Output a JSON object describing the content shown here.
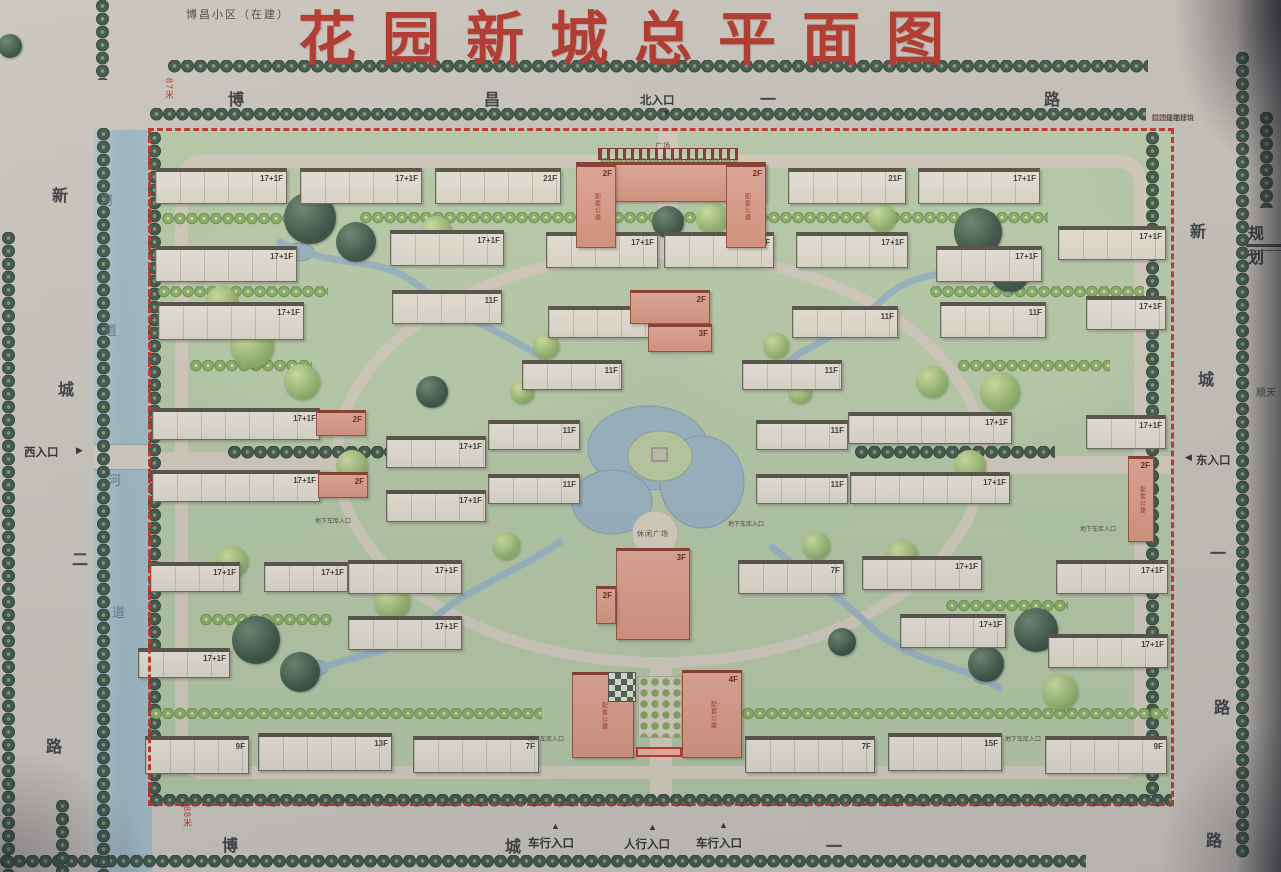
{
  "title": "花园新城总平面图",
  "adjacent": {
    "top_left_label": "博昌小区（在建）",
    "right_sheet_heading": "规划",
    "right_sheet_text": "顺天",
    "north_road_width": "87米",
    "south_road_width": "88米"
  },
  "colors": {
    "title_red": "#b5352c",
    "boundary_red": "#c5352a",
    "river_blue": "#a3bfca",
    "tree_dark": "#41594a",
    "tree_light": "#9dbf72",
    "building_white": "#e9e5da",
    "building_pink": "#dfa190",
    "road_gray": "#cfcbc4",
    "ground_green": "#b9cdae"
  },
  "legend": {
    "items": [
      {
        "label": "征地范围",
        "swatch": "red-dash"
      },
      {
        "label": "已建绿化林带",
        "swatch": "green"
      },
      {
        "label": "已建住宅建筑",
        "swatch": "white"
      },
      {
        "label": "拟建住宅建筑",
        "swatch": "pink"
      }
    ]
  },
  "roads": {
    "top": {
      "name": "博昌一路",
      "chars": [
        {
          "t": "博",
          "x": 228,
          "y": 86
        },
        {
          "t": "昌",
          "x": 484,
          "y": 86
        },
        {
          "t": "一",
          "x": 760,
          "y": 86
        },
        {
          "t": "路",
          "x": 1044,
          "y": 86
        }
      ]
    },
    "bottom": {
      "name": "博城一路",
      "chars": [
        {
          "t": "博",
          "x": 222,
          "y": 832
        },
        {
          "t": "城",
          "x": 505,
          "y": 833
        },
        {
          "t": "一",
          "x": 826,
          "y": 833
        },
        {
          "t": "路",
          "x": 1206,
          "y": 827
        }
      ]
    },
    "left": {
      "name": "新城二路",
      "chars": [
        {
          "t": "新",
          "x": 52,
          "y": 182
        },
        {
          "t": "城",
          "x": 58,
          "y": 376
        },
        {
          "t": "二",
          "x": 72,
          "y": 546
        },
        {
          "t": "路",
          "x": 46,
          "y": 733
        }
      ]
    },
    "right": {
      "name": "新城一路",
      "chars": [
        {
          "t": "新",
          "x": 1190,
          "y": 218
        },
        {
          "t": "城",
          "x": 1198,
          "y": 366
        },
        {
          "t": "一",
          "x": 1210,
          "y": 540
        },
        {
          "t": "路",
          "x": 1214,
          "y": 694
        }
      ]
    }
  },
  "river": {
    "name": "河道",
    "chars": [
      {
        "t": "河",
        "x": 100,
        "y": 190
      },
      {
        "t": "道",
        "x": 104,
        "y": 320
      },
      {
        "t": "河",
        "x": 108,
        "y": 470
      },
      {
        "t": "道",
        "x": 112,
        "y": 602
      }
    ]
  },
  "entrances": {
    "north": {
      "label": "北入口",
      "x": 640,
      "y": 92,
      "arrow": "▼",
      "ax": 662,
      "ay": 108
    },
    "west": {
      "label": "西入口",
      "x": 24,
      "y": 444,
      "arrow": "▶",
      "ax": 76,
      "ay": 445
    },
    "east": {
      "label": "东入口",
      "x": 1196,
      "y": 452,
      "arrow": "◀",
      "ax": 1185,
      "ay": 452
    },
    "south": [
      {
        "label": "车行入口",
        "x": 528,
        "y": 835,
        "arrow": "▲",
        "ax": 551,
        "ay": 821
      },
      {
        "label": "人行入口",
        "x": 624,
        "y": 836,
        "arrow": "▲",
        "ax": 648,
        "ay": 822
      },
      {
        "label": "车行入口",
        "x": 696,
        "y": 835,
        "arrow": "▲",
        "ax": 719,
        "ay": 820
      }
    ]
  },
  "map": {
    "facility_label": "配套公建",
    "plaza_labels": [
      {
        "t": "广场",
        "x": 655,
        "y": 141
      },
      {
        "t": "休闲广场",
        "x": 637,
        "y": 529
      }
    ],
    "micro_labels": [
      {
        "t": "地下车库入口",
        "x": 315,
        "y": 516
      },
      {
        "t": "地下车库入口",
        "x": 728,
        "y": 519
      },
      {
        "t": "地下车库入口",
        "x": 1080,
        "y": 524
      },
      {
        "t": "地下车库入口",
        "x": 528,
        "y": 734
      },
      {
        "t": "地下车库入口",
        "x": 1005,
        "y": 734
      }
    ],
    "buildings": [
      {
        "x": 155,
        "y": 168,
        "w": 132,
        "h": 36,
        "label": "17+1F",
        "type": "slab"
      },
      {
        "x": 300,
        "y": 168,
        "w": 122,
        "h": 36,
        "label": "17+1F",
        "type": "slab"
      },
      {
        "x": 435,
        "y": 168,
        "w": 126,
        "h": 36,
        "label": "21F",
        "type": "slab"
      },
      {
        "x": 788,
        "y": 168,
        "w": 118,
        "h": 36,
        "label": "21F",
        "type": "slab"
      },
      {
        "x": 918,
        "y": 168,
        "w": 122,
        "h": 36,
        "label": "17+1F",
        "type": "slab"
      },
      {
        "x": 1058,
        "y": 226,
        "w": 108,
        "h": 34,
        "label": "17+1F",
        "type": "slab"
      },
      {
        "x": 1086,
        "y": 296,
        "w": 80,
        "h": 34,
        "label": "17+1F",
        "type": "slab"
      },
      {
        "x": 1086,
        "y": 415,
        "w": 80,
        "h": 34,
        "label": "17+1F",
        "type": "slab"
      },
      {
        "x": 155,
        "y": 246,
        "w": 142,
        "h": 36,
        "label": "17+1F",
        "type": "slab"
      },
      {
        "x": 390,
        "y": 230,
        "w": 114,
        "h": 36,
        "label": "17+1F",
        "type": "slab"
      },
      {
        "x": 546,
        "y": 232,
        "w": 112,
        "h": 36,
        "label": "17+1F",
        "type": "slab"
      },
      {
        "x": 664,
        "y": 232,
        "w": 110,
        "h": 36,
        "label": "17+1F",
        "type": "slab"
      },
      {
        "x": 796,
        "y": 232,
        "w": 112,
        "h": 36,
        "label": "17+1F",
        "type": "slab"
      },
      {
        "x": 936,
        "y": 246,
        "w": 106,
        "h": 36,
        "label": "17+1F",
        "type": "slab"
      },
      {
        "x": 158,
        "y": 302,
        "w": 146,
        "h": 38,
        "label": "17+1F",
        "type": "slab"
      },
      {
        "x": 392,
        "y": 290,
        "w": 110,
        "h": 34,
        "label": "11F",
        "type": "slab"
      },
      {
        "x": 548,
        "y": 306,
        "w": 106,
        "h": 32,
        "label": "11F",
        "type": "slab"
      },
      {
        "x": 792,
        "y": 306,
        "w": 106,
        "h": 32,
        "label": "11F",
        "type": "slab"
      },
      {
        "x": 940,
        "y": 302,
        "w": 106,
        "h": 36,
        "label": "11F",
        "type": "slab"
      },
      {
        "x": 522,
        "y": 360,
        "w": 100,
        "h": 30,
        "label": "11F",
        "type": "slab"
      },
      {
        "x": 742,
        "y": 360,
        "w": 100,
        "h": 30,
        "label": "11F",
        "type": "slab"
      },
      {
        "x": 488,
        "y": 420,
        "w": 92,
        "h": 30,
        "label": "11F",
        "type": "slab"
      },
      {
        "x": 488,
        "y": 474,
        "w": 92,
        "h": 30,
        "label": "11F",
        "type": "slab"
      },
      {
        "x": 756,
        "y": 420,
        "w": 92,
        "h": 30,
        "label": "11F",
        "type": "slab"
      },
      {
        "x": 756,
        "y": 474,
        "w": 92,
        "h": 30,
        "label": "11F",
        "type": "slab"
      },
      {
        "x": 152,
        "y": 408,
        "w": 168,
        "h": 32,
        "label": "17+1F",
        "type": "slab"
      },
      {
        "x": 152,
        "y": 470,
        "w": 168,
        "h": 32,
        "label": "17+1F",
        "type": "slab"
      },
      {
        "x": 386,
        "y": 436,
        "w": 100,
        "h": 32,
        "label": "17+1F",
        "type": "slab"
      },
      {
        "x": 386,
        "y": 490,
        "w": 100,
        "h": 32,
        "label": "17+1F",
        "type": "slab"
      },
      {
        "x": 848,
        "y": 412,
        "w": 164,
        "h": 32,
        "label": "17+1F",
        "type": "slab"
      },
      {
        "x": 850,
        "y": 472,
        "w": 160,
        "h": 32,
        "label": "17+1F",
        "type": "slab"
      },
      {
        "x": 150,
        "y": 562,
        "w": 90,
        "h": 30,
        "label": "17+1F",
        "type": "slab"
      },
      {
        "x": 264,
        "y": 562,
        "w": 84,
        "h": 30,
        "label": "17+1F",
        "type": "slab"
      },
      {
        "x": 138,
        "y": 648,
        "w": 92,
        "h": 30,
        "label": "17+1F",
        "type": "slab"
      },
      {
        "x": 348,
        "y": 560,
        "w": 114,
        "h": 34,
        "label": "17+1F",
        "type": "slab"
      },
      {
        "x": 348,
        "y": 616,
        "w": 114,
        "h": 34,
        "label": "17+1F",
        "type": "slab"
      },
      {
        "x": 738,
        "y": 560,
        "w": 106,
        "h": 34,
        "label": "7F",
        "type": "slab"
      },
      {
        "x": 862,
        "y": 556,
        "w": 120,
        "h": 34,
        "label": "17+1F",
        "type": "slab"
      },
      {
        "x": 900,
        "y": 614,
        "w": 106,
        "h": 34,
        "label": "17+1F",
        "type": "slab"
      },
      {
        "x": 1056,
        "y": 560,
        "w": 112,
        "h": 34,
        "label": "17+1F",
        "type": "slab"
      },
      {
        "x": 1048,
        "y": 634,
        "w": 120,
        "h": 34,
        "label": "17+1F",
        "type": "slab"
      },
      {
        "x": 145,
        "y": 736,
        "w": 104,
        "h": 38,
        "label": "9F",
        "type": "slab"
      },
      {
        "x": 258,
        "y": 733,
        "w": 134,
        "h": 38,
        "label": "13F",
        "type": "slab"
      },
      {
        "x": 413,
        "y": 736,
        "w": 126,
        "h": 37,
        "label": "7F",
        "type": "slab"
      },
      {
        "x": 745,
        "y": 736,
        "w": 130,
        "h": 37,
        "label": "7F",
        "type": "slab"
      },
      {
        "x": 888,
        "y": 733,
        "w": 114,
        "h": 38,
        "label": "15F",
        "type": "slab"
      },
      {
        "x": 1045,
        "y": 736,
        "w": 122,
        "h": 38,
        "label": "9F",
        "type": "slab"
      },
      {
        "x": 576,
        "y": 162,
        "w": 190,
        "h": 40,
        "label": "26F",
        "type": "pink"
      },
      {
        "x": 576,
        "y": 164,
        "w": 40,
        "h": 84,
        "label": "2F",
        "type": "pink",
        "fac": true
      },
      {
        "x": 726,
        "y": 164,
        "w": 40,
        "h": 84,
        "label": "2F",
        "type": "pink",
        "fac": true
      },
      {
        "x": 630,
        "y": 290,
        "w": 80,
        "h": 34,
        "label": "2F",
        "type": "pink"
      },
      {
        "x": 648,
        "y": 324,
        "w": 64,
        "h": 28,
        "label": "3F",
        "type": "pink"
      },
      {
        "x": 616,
        "y": 548,
        "w": 74,
        "h": 92,
        "label": "3F",
        "type": "pink"
      },
      {
        "x": 596,
        "y": 586,
        "w": 20,
        "h": 38,
        "label": "2F",
        "type": "pink"
      },
      {
        "x": 572,
        "y": 672,
        "w": 62,
        "h": 86,
        "label": "4F",
        "type": "pink",
        "fac": true
      },
      {
        "x": 682,
        "y": 670,
        "w": 60,
        "h": 88,
        "label": "4F",
        "type": "pink",
        "fac": true
      },
      {
        "x": 316,
        "y": 410,
        "w": 50,
        "h": 26,
        "label": "2F",
        "type": "pink"
      },
      {
        "x": 318,
        "y": 472,
        "w": 50,
        "h": 26,
        "label": "2F",
        "type": "pink"
      },
      {
        "x": 1128,
        "y": 456,
        "w": 26,
        "h": 86,
        "label": "2F",
        "type": "pink",
        "fac": true
      },
      {
        "x": 598,
        "y": 148,
        "w": 140,
        "h": 12,
        "label": "",
        "type": "pergola"
      },
      {
        "x": 608,
        "y": 672,
        "w": 28,
        "h": 30,
        "label": "",
        "type": "checker"
      },
      {
        "x": 638,
        "y": 676,
        "w": 44,
        "h": 62,
        "label": "",
        "type": "treegrid"
      },
      {
        "x": 636,
        "y": 747,
        "w": 46,
        "h": 10,
        "label": "",
        "type": "redstrip"
      }
    ],
    "tree_rows": [
      {
        "x": 168,
        "y": 60,
        "l": 980,
        "o": "h",
        "k": "d"
      },
      {
        "x": 150,
        "y": 108,
        "l": 996,
        "o": "h",
        "k": "d"
      },
      {
        "x": 150,
        "y": 794,
        "l": 1022,
        "o": "h",
        "k": "d"
      },
      {
        "x": 0,
        "y": 855,
        "l": 1086,
        "o": "h",
        "k": "d"
      },
      {
        "x": 96,
        "y": 0,
        "l": 80,
        "o": "v",
        "k": "d"
      },
      {
        "x": 97,
        "y": 128,
        "l": 744,
        "o": "v",
        "k": "d"
      },
      {
        "x": 2,
        "y": 232,
        "l": 640,
        "o": "v",
        "k": "d"
      },
      {
        "x": 148,
        "y": 132,
        "l": 664,
        "o": "v",
        "k": "d"
      },
      {
        "x": 1146,
        "y": 132,
        "l": 664,
        "o": "v",
        "k": "d"
      },
      {
        "x": 1236,
        "y": 52,
        "l": 806,
        "o": "v",
        "k": "d"
      },
      {
        "x": 1260,
        "y": 112,
        "l": 96,
        "o": "v",
        "k": "d"
      },
      {
        "x": 56,
        "y": 800,
        "l": 72,
        "o": "v",
        "k": "d"
      },
      {
        "x": 360,
        "y": 212,
        "l": 688,
        "o": "h",
        "k": "l"
      },
      {
        "x": 162,
        "y": 213,
        "l": 172,
        "o": "h",
        "k": "l"
      },
      {
        "x": 930,
        "y": 286,
        "l": 214,
        "o": "h",
        "k": "l"
      },
      {
        "x": 158,
        "y": 286,
        "l": 170,
        "o": "h",
        "k": "l"
      },
      {
        "x": 228,
        "y": 446,
        "l": 198,
        "o": "h",
        "k": "d"
      },
      {
        "x": 855,
        "y": 446,
        "l": 200,
        "o": "h",
        "k": "d"
      },
      {
        "x": 150,
        "y": 708,
        "l": 392,
        "o": "h",
        "k": "l"
      },
      {
        "x": 742,
        "y": 708,
        "l": 426,
        "o": "h",
        "k": "l"
      },
      {
        "x": 190,
        "y": 360,
        "l": 122,
        "o": "h",
        "k": "l"
      },
      {
        "x": 958,
        "y": 360,
        "l": 152,
        "o": "h",
        "k": "l"
      },
      {
        "x": 200,
        "y": 614,
        "l": 132,
        "o": "h",
        "k": "l"
      },
      {
        "x": 946,
        "y": 600,
        "l": 122,
        "o": "h",
        "k": "l"
      },
      {
        "x": 600,
        "y": 158,
        "l": 138,
        "o": "h",
        "k": "l"
      }
    ],
    "tree_blobs": [
      {
        "x": 310,
        "y": 218,
        "r": 26,
        "k": "d"
      },
      {
        "x": 356,
        "y": 242,
        "r": 20,
        "k": "d"
      },
      {
        "x": 252,
        "y": 346,
        "r": 22,
        "k": "l"
      },
      {
        "x": 302,
        "y": 382,
        "r": 18,
        "k": "l"
      },
      {
        "x": 432,
        "y": 392,
        "r": 16,
        "k": "d"
      },
      {
        "x": 222,
        "y": 302,
        "r": 16,
        "k": "l"
      },
      {
        "x": 978,
        "y": 232,
        "r": 24,
        "k": "d"
      },
      {
        "x": 1010,
        "y": 272,
        "r": 20,
        "k": "d"
      },
      {
        "x": 1000,
        "y": 392,
        "r": 20,
        "k": "l"
      },
      {
        "x": 932,
        "y": 382,
        "r": 16,
        "k": "l"
      },
      {
        "x": 1036,
        "y": 630,
        "r": 22,
        "k": "d"
      },
      {
        "x": 986,
        "y": 664,
        "r": 18,
        "k": "d"
      },
      {
        "x": 256,
        "y": 640,
        "r": 24,
        "k": "d"
      },
      {
        "x": 300,
        "y": 672,
        "r": 20,
        "k": "d"
      },
      {
        "x": 232,
        "y": 562,
        "r": 16,
        "k": "l"
      },
      {
        "x": 392,
        "y": 586,
        "r": 14,
        "k": "l"
      },
      {
        "x": 902,
        "y": 556,
        "r": 16,
        "k": "l"
      },
      {
        "x": 1060,
        "y": 692,
        "r": 18,
        "k": "l"
      },
      {
        "x": 842,
        "y": 642,
        "r": 14,
        "k": "d"
      },
      {
        "x": 506,
        "y": 546,
        "r": 14,
        "k": "l"
      },
      {
        "x": 816,
        "y": 546,
        "r": 14,
        "k": "l"
      },
      {
        "x": 522,
        "y": 392,
        "r": 12,
        "k": "l"
      },
      {
        "x": 800,
        "y": 392,
        "r": 12,
        "k": "l"
      },
      {
        "x": 392,
        "y": 602,
        "r": 18,
        "k": "l"
      },
      {
        "x": 436,
        "y": 232,
        "r": 16,
        "k": "l"
      },
      {
        "x": 712,
        "y": 218,
        "r": 16,
        "k": "l"
      },
      {
        "x": 882,
        "y": 218,
        "r": 14,
        "k": "l"
      },
      {
        "x": 970,
        "y": 466,
        "r": 16,
        "k": "l"
      },
      {
        "x": 352,
        "y": 466,
        "r": 16,
        "k": "l"
      },
      {
        "x": 546,
        "y": 346,
        "r": 13,
        "k": "l"
      },
      {
        "x": 776,
        "y": 346,
        "r": 13,
        "k": "l"
      },
      {
        "x": 668,
        "y": 222,
        "r": 16,
        "k": "d"
      },
      {
        "x": 10,
        "y": 46,
        "r": 12,
        "k": "d"
      }
    ]
  }
}
